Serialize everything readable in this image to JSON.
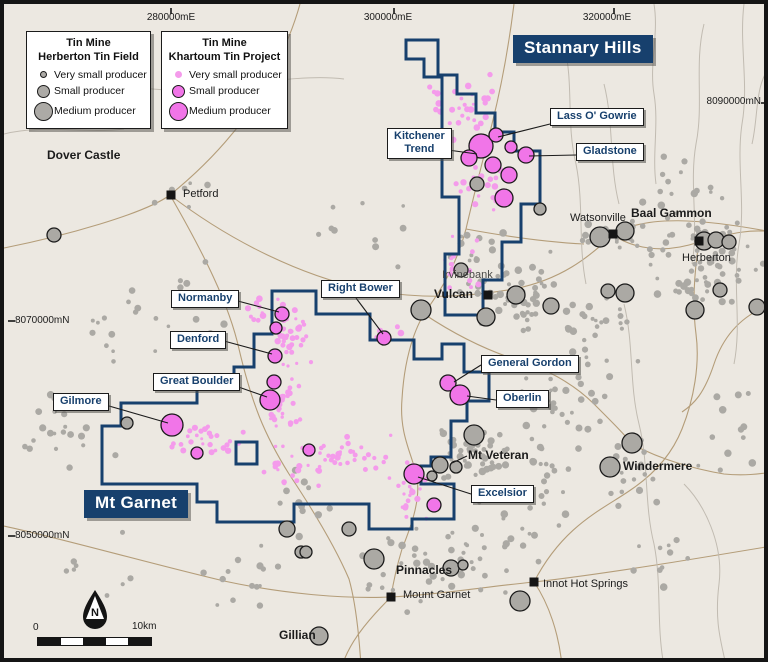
{
  "colors": {
    "bg": "#ECE8E1",
    "navy": "#17406D",
    "pink": "#F175E8",
    "pinkSmall": "#F49BEB",
    "gray": "#ABA9A4",
    "outline": "#1b1b1b",
    "road": "#B49D79",
    "creek": "#C1BBB1",
    "text": "#1b1b1b",
    "marker": "#151515"
  },
  "legends": [
    {
      "title1": "Tin Mine",
      "title2": "Herberton Tin Field",
      "x": 22,
      "y": 27,
      "w": 125,
      "items": [
        {
          "label": "Very small producer"
        },
        {
          "label": "Small producer"
        },
        {
          "label": "Medium producer"
        }
      ]
    },
    {
      "title1": "Tin Mine",
      "title2": "Khartoum Tin Project",
      "x": 157,
      "y": 27,
      "w": 127,
      "items": [
        {
          "label": "Very small producer"
        },
        {
          "label": "Small producer"
        },
        {
          "label": "Medium producer"
        }
      ]
    }
  ],
  "area_labels": [
    {
      "text": "Stannary Hills",
      "x": 509,
      "y": 31
    },
    {
      "text": "Mt Garnet",
      "x": 80,
      "y": 486
    }
  ],
  "deposit_labels": [
    {
      "text": "Kitchener\nTrend",
      "x": 383,
      "y": 124
    },
    {
      "text": "Lass O' Gowrie",
      "x": 546,
      "y": 104
    },
    {
      "text": "Gladstone",
      "x": 572,
      "y": 139
    },
    {
      "text": "Normanby",
      "x": 167,
      "y": 286
    },
    {
      "text": "Denford",
      "x": 166,
      "y": 327
    },
    {
      "text": "Great Boulder",
      "x": 149,
      "y": 369
    },
    {
      "text": "Gilmore",
      "x": 49,
      "y": 389
    },
    {
      "text": "Right Bower",
      "x": 317,
      "y": 276
    },
    {
      "text": "General Gordon",
      "x": 477,
      "y": 351
    },
    {
      "text": "Oberlin",
      "x": 492,
      "y": 386
    },
    {
      "text": "Excelsior",
      "x": 467,
      "y": 481
    }
  ],
  "leaders": [
    [
      444,
      146,
      473,
      150
    ],
    [
      546,
      120,
      494,
      133
    ],
    [
      572,
      151,
      525,
      152
    ],
    [
      230,
      296,
      275,
      308
    ],
    [
      220,
      337,
      268,
      350
    ],
    [
      226,
      380,
      263,
      393
    ],
    [
      98,
      400,
      164,
      419
    ],
    [
      352,
      294,
      379,
      330
    ],
    [
      477,
      361,
      450,
      378
    ],
    [
      492,
      396,
      463,
      392
    ],
    [
      467,
      490,
      414,
      473
    ],
    [
      463,
      452,
      448,
      459
    ]
  ],
  "towns": [
    {
      "name": "Dover Castle",
      "x": 43,
      "y": 145,
      "bold": true
    },
    {
      "name": "Petford",
      "x": 179,
      "y": 185,
      "marker": [
        167,
        191
      ]
    },
    {
      "name": "Watsonville",
      "x": 566,
      "y": 209,
      "marker": [
        609,
        230
      ]
    },
    {
      "name": "Baal Gammon",
      "x": 627,
      "y": 203,
      "bold": true
    },
    {
      "name": "Herberton",
      "x": 678,
      "y": 249,
      "marker": [
        695,
        237
      ]
    },
    {
      "name": "Irvinebank",
      "x": 438,
      "y": 266,
      "muted": true
    },
    {
      "name": "Vulcan",
      "x": 430,
      "y": 284,
      "bold": true,
      "marker": [
        484,
        291
      ]
    },
    {
      "name": "Mt Veteran",
      "x": 464,
      "y": 445,
      "bold": true
    },
    {
      "name": "Windermere",
      "x": 619,
      "y": 456,
      "bold": true
    },
    {
      "name": "Pinnacles",
      "x": 392,
      "y": 560,
      "bold": true
    },
    {
      "name": "Mount Garnet",
      "x": 399,
      "y": 586,
      "marker": [
        387,
        593
      ]
    },
    {
      "name": "Innot Hot Springs",
      "x": 539,
      "y": 575,
      "marker": [
        530,
        578
      ]
    },
    {
      "name": "Gillian",
      "x": 275,
      "y": 625,
      "bold": true
    }
  ],
  "grid_labels": [
    {
      "text": "280000mE",
      "x": 167,
      "y": 8,
      "anchor": "middle",
      "tick": [
        167,
        4,
        167,
        10
      ]
    },
    {
      "text": "300000mE",
      "x": 384,
      "y": 8,
      "anchor": "middle",
      "tick": [
        390,
        4,
        390,
        10
      ]
    },
    {
      "text": "320000mE",
      "x": 603,
      "y": 8,
      "anchor": "middle",
      "tick": [
        610,
        4,
        610,
        10
      ]
    },
    {
      "text": "8090000mN",
      "x": 757,
      "y": 92,
      "anchor": "end",
      "tick": [
        757,
        99,
        764,
        99
      ]
    },
    {
      "text": "8070000mN",
      "x": 11,
      "y": 311,
      "anchor": "start",
      "tick": [
        4,
        317,
        11,
        317
      ]
    },
    {
      "text": "8050000mN",
      "x": 11,
      "y": 526,
      "anchor": "start",
      "tick": [
        4,
        532,
        11,
        532
      ]
    }
  ],
  "scalebar": {
    "x": 33,
    "y": 633,
    "w": 113,
    "h": 7,
    "segments": 5,
    "label0": "0",
    "label1": "10km"
  },
  "north": {
    "x": 76,
    "y": 584,
    "label": "N"
  },
  "boundaries": {
    "stannary": "M402,36 H434 V71 H453 V90 H472 V109 H491 V128 H510 V147 H536 V200 H517 V238 H498 V276 H479 V311 H441 V250 H455 V193 H438 V73 H420 V55 H402 Z",
    "khartoum": "M268,287 H312 V310 H366 V336 H410 V355 H438 V340 H460 V368 H485 V397 H463 V417 H447 V453 H427 V462 H417 V480 H450 V515 H408 V525 H365 V500 H290 V518 H213 V498 H193 V480 H98 V422 H117 V399 H193 V380 H230 V363 H250 V330 H268 Z",
    "khartoum_hole": "M232,438 H253 V460 H232 Z"
  },
  "features": {
    "pink": [
      [
        477,
        142,
        12
      ],
      [
        465,
        154,
        8
      ],
      [
        492,
        131,
        7
      ],
      [
        489,
        161,
        8
      ],
      [
        507,
        143,
        6
      ],
      [
        505,
        171,
        8
      ],
      [
        522,
        151,
        8
      ],
      [
        500,
        194,
        9
      ],
      [
        278,
        310,
        7
      ],
      [
        272,
        324,
        6
      ],
      [
        271,
        352,
        7
      ],
      [
        270,
        378,
        7
      ],
      [
        266,
        396,
        10
      ],
      [
        168,
        421,
        11
      ],
      [
        193,
        449,
        6
      ],
      [
        305,
        446,
        6
      ],
      [
        380,
        334,
        7
      ],
      [
        444,
        379,
        8
      ],
      [
        456,
        391,
        10
      ],
      [
        410,
        470,
        10
      ],
      [
        430,
        501,
        7
      ]
    ],
    "gray": [
      [
        50,
        231,
        7
      ],
      [
        417,
        306,
        10
      ],
      [
        482,
        313,
        9
      ],
      [
        512,
        291,
        9
      ],
      [
        547,
        302,
        8
      ],
      [
        604,
        287,
        7
      ],
      [
        621,
        289,
        9
      ],
      [
        716,
        286,
        7
      ],
      [
        753,
        303,
        8
      ],
      [
        596,
        233,
        10
      ],
      [
        621,
        227,
        9
      ],
      [
        700,
        237,
        9
      ],
      [
        712,
        236,
        8
      ],
      [
        725,
        238,
        7
      ],
      [
        691,
        306,
        9
      ],
      [
        473,
        180,
        7
      ],
      [
        457,
        266,
        7
      ],
      [
        470,
        431,
        10
      ],
      [
        436,
        461,
        8
      ],
      [
        452,
        463,
        6
      ],
      [
        428,
        472,
        5
      ],
      [
        628,
        439,
        10
      ],
      [
        606,
        463,
        10
      ],
      [
        370,
        555,
        10
      ],
      [
        447,
        564,
        8
      ],
      [
        459,
        561,
        5
      ],
      [
        516,
        597,
        10
      ],
      [
        315,
        632,
        9
      ],
      [
        283,
        525,
        8
      ],
      [
        297,
        548,
        6
      ],
      [
        123,
        419,
        6
      ],
      [
        536,
        205,
        6
      ],
      [
        345,
        525,
        7
      ],
      [
        302,
        548,
        6
      ]
    ]
  },
  "dot_clusters": {
    "gray": [
      [
        700,
        255,
        62,
        62,
        70
      ],
      [
        608,
        232,
        38,
        22,
        22
      ],
      [
        505,
        290,
        62,
        45,
        60
      ],
      [
        560,
        395,
        55,
        55,
        35
      ],
      [
        468,
        448,
        42,
        28,
        45
      ],
      [
        628,
        470,
        40,
        40,
        18
      ],
      [
        430,
        565,
        85,
        45,
        40
      ],
      [
        250,
        565,
        60,
        45,
        16
      ],
      [
        60,
        432,
        55,
        48,
        20
      ],
      [
        170,
        300,
        85,
        60,
        16
      ],
      [
        350,
        230,
        60,
        40,
        10
      ],
      [
        600,
        325,
        50,
        40,
        25
      ],
      [
        676,
        180,
        45,
        45,
        14
      ],
      [
        520,
        525,
        55,
        40,
        18
      ],
      [
        95,
        560,
        60,
        40,
        8
      ],
      [
        300,
        487,
        40,
        35,
        10
      ],
      [
        480,
        245,
        40,
        28,
        12
      ],
      [
        725,
        430,
        35,
        55,
        12
      ],
      [
        545,
        470,
        35,
        30,
        14
      ],
      [
        660,
        560,
        50,
        40,
        10
      ],
      [
        180,
        190,
        40,
        30,
        6
      ],
      [
        90,
        330,
        40,
        40,
        8
      ]
    ],
    "pink": [
      [
        468,
        115,
        26,
        48,
        30
      ],
      [
        482,
        178,
        32,
        36,
        30
      ],
      [
        452,
        262,
        26,
        40,
        18
      ],
      [
        286,
        330,
        22,
        42,
        38
      ],
      [
        280,
        400,
        22,
        38,
        28
      ],
      [
        200,
        437,
        45,
        22,
        28
      ],
      [
        292,
        462,
        38,
        26,
        22
      ],
      [
        360,
        452,
        38,
        30,
        18
      ],
      [
        404,
        482,
        22,
        38,
        24
      ],
      [
        381,
        331,
        16,
        10,
        8
      ],
      [
        432,
        95,
        12,
        22,
        6
      ],
      [
        335,
        448,
        28,
        20,
        12
      ],
      [
        260,
        310,
        18,
        18,
        10
      ]
    ]
  },
  "roads": [
    "M296,0 C285,40 258,95 228,130 C205,158 182,178 166,191 C140,210 60,232 0,244",
    "M166,191 C200,250 225,300 235,345 C248,400 260,430 285,470 C305,500 330,540 345,575 C352,600 355,630 357,662",
    "M510,0 C505,40 498,80 488,120 C478,160 470,190 462,225 C450,270 430,295 420,310 C408,330 400,360 398,395 C395,430 408,450 412,470 C418,492 408,520 398,545 C392,565 389,580 387,593",
    "M0,522 C60,535 140,558 220,577 C280,590 340,595 387,593 C430,591 480,583 530,578 C600,570 690,555 768,542",
    "M387,593 C360,620 345,640 338,662",
    "M166,191 C230,240 300,272 360,285 C420,297 470,292 510,285 C560,275 585,252 609,231 C640,210 700,215 768,228",
    "M609,231 C630,245 660,250 695,238 C730,228 750,225 768,228",
    "M695,238 C690,270 688,300 692,330 C696,360 690,395 678,425 C668,450 650,470 628,485 C600,505 560,520 530,578",
    "M530,578 C545,600 555,630 558,662",
    "M628,440 C655,455 690,465 720,470 C740,472 755,470 768,468",
    "M462,225 C500,232 540,238 580,240",
    "M420,310 C450,330 480,345 510,355 C540,363 570,380 590,400 C610,420 620,430 628,440",
    "M768,300 C740,310 720,330 710,360 C700,390 690,400 678,408"
  ],
  "creeks": [
    "M650,0 C655,30 645,60 650,90 C655,120 648,150 652,180",
    "M700,20 C690,60 700,100 692,140 C685,180 695,220 688,260",
    "M740,0 C735,40 745,80 738,120 C732,160 742,200 735,240 C728,280 738,320 730,360",
    "M768,60 C750,80 755,110 748,140",
    "M620,300 C630,340 625,380 635,420 C645,460 640,500 650,540 C658,580 652,620 660,662",
    "M680,480 C700,500 720,540 715,580 C710,620 718,640 722,662",
    "M60,60 C100,80 150,90 200,85 C250,80 300,70 340,75",
    "M0,130 C40,120 80,130 120,125",
    "M600,80 C610,120 605,160 615,200",
    "M560,40 C570,80 562,120 572,160 C580,200 574,240 582,280"
  ]
}
